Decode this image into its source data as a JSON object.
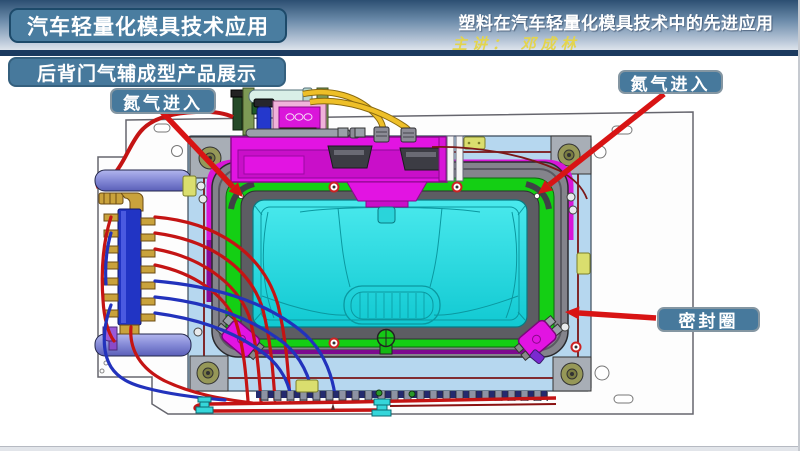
{
  "slide": {
    "header": {
      "course_title": "汽车轻量化模具技术应用",
      "lecture_title": "塑料在汽车轻量化模具技术中的先进应用",
      "presenter": "主讲： 邓成林"
    },
    "section_title": "后背门气辅成型产品展示",
    "callouts": [
      {
        "id": "nitrogen-inlet-left",
        "label": "氮气进入"
      },
      {
        "id": "nitrogen-inlet-right",
        "label": "氮气进入"
      },
      {
        "id": "seal-ring",
        "label": "密封圈"
      }
    ],
    "colors": {
      "header_navy": "#1b3a5f",
      "label_box_blue": "#47799c",
      "arrow_red": "#d81414",
      "mold_plate_blue": "#b6d7ef",
      "mold_frame_gray": "#84848c",
      "mold_green": "#14cf14",
      "mold_cyan": "#1fd9de",
      "mold_magenta": "#e214e2",
      "hose_yellow": "#eebf28",
      "tube_red": "#c41414",
      "tube_blue": "#2232bc"
    }
  }
}
